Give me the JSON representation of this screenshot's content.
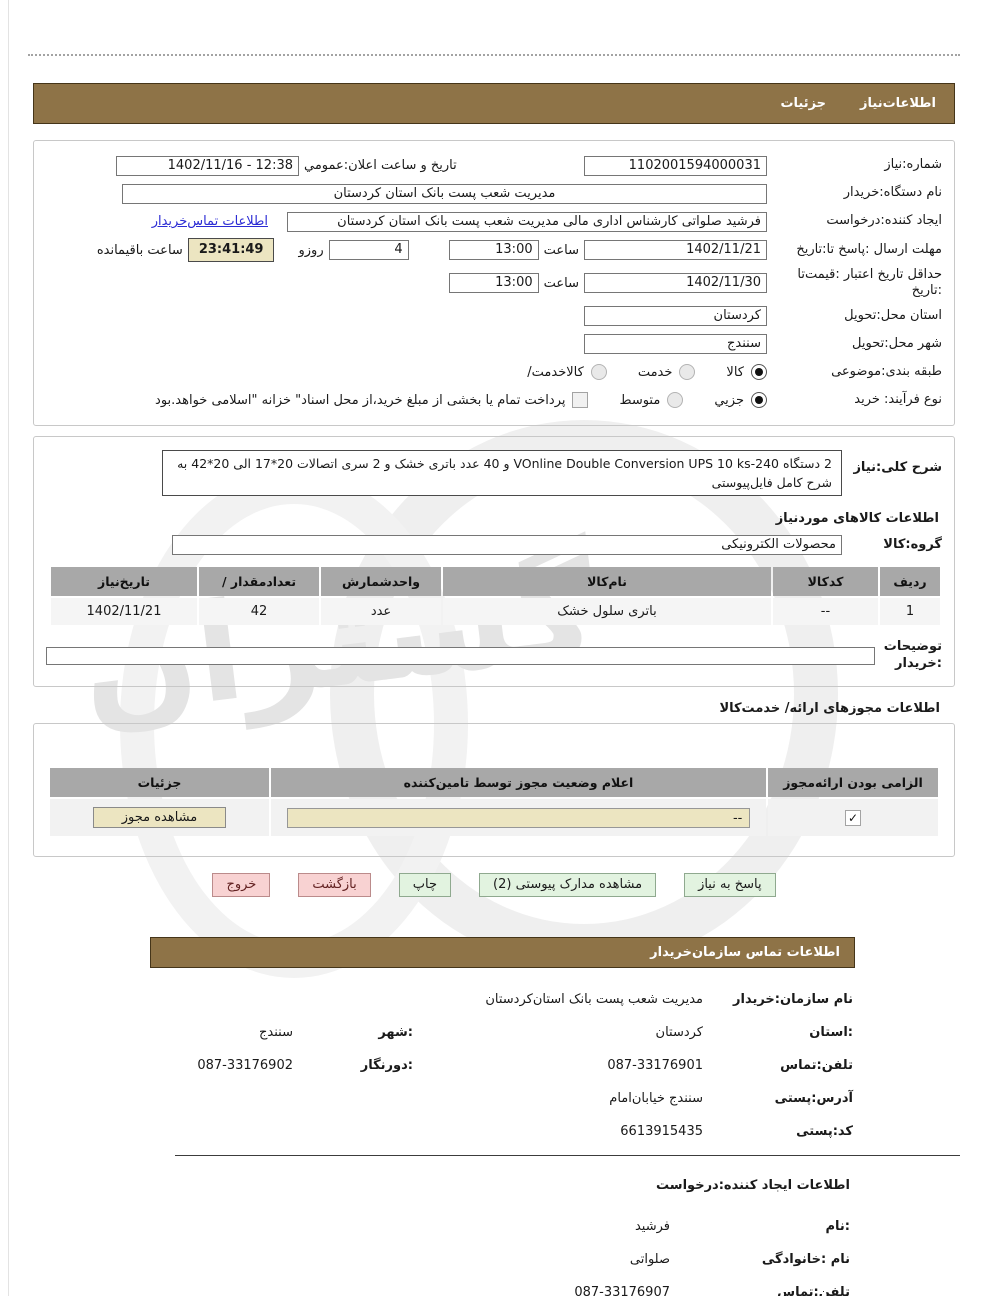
{
  "colors": {
    "header_brown": "#8e7347",
    "link_blue": "#2b2bd4",
    "button_green_bg": "#e2f3e0",
    "button_pink_bg": "#f8d2d2",
    "highlight_beige": "#ece5c1",
    "table_header_gray": "#a8a8a8"
  },
  "watermark": {
    "text": "گستران"
  },
  "tabs": {
    "need_info": "اطلاعات‌نیاز",
    "details": "جزئیات"
  },
  "need_form": {
    "need_number_label": "شماره:نیاز",
    "need_number": "1102001594000031",
    "announce_label": "تاریخ و ساعت اعلان:عمومي",
    "announce_value": "12:38 - 1402/11/16",
    "org_label": "نام دستگاه:خریدار",
    "org_value": "مدیریت شعب پست بانک استان کردستان",
    "creator_label": "ایجاد کننده:درخواست",
    "creator_value": "فرشید صلواتی کارشناس اداری مالی مدیریت شعب پست بانک استان کردستان",
    "contact_link": "اطلاعات تماس‌خریدار",
    "deadline_label": "مهلت ارسال :پاسخ تا:تاریخ",
    "deadline_date": "1402/11/21",
    "hour_label": "ساعت",
    "deadline_time": "13:00",
    "days_value": "4",
    "days_label": "روزو",
    "remaining_value": "23:41:49",
    "remaining_label": "ساعت باقیمانده",
    "validity_label": "حداقل تاریخ اعتبار :قیمت‌تا :تاریخ",
    "validity_date": "1402/11/30",
    "validity_time": "13:00",
    "province_label": "استان محل:تحویل",
    "province_value": "کردستان",
    "city_label": "شهر محل:تحویل",
    "city_value": "سنندج",
    "category_label": "طبقه بندی:موضوعی",
    "category_options": [
      {
        "label": "کالا",
        "selected": true
      },
      {
        "label": "خدمت",
        "selected": false
      },
      {
        "label": "کالاخدمت/",
        "selected": false
      }
    ],
    "process_label": "نوع فرآیند: خرید",
    "process_options": [
      {
        "label": "جزیي",
        "selected": true
      },
      {
        "label": "متوسط",
        "selected": false
      }
    ],
    "payment_checkbox_checked": false,
    "payment_checkbox_label": "پرداخت تمام یا بخشی از مبلغ خرید،از محل اسناد\" خزانه \"اسلامی خواهد.بود"
  },
  "description": {
    "label": "شرح کلی:نیاز",
    "text": "2 دستگاه   VOnline Double Conversion UPS 10 ks-240 و 40 عدد باتری خشک و 2 سری اتصالات 20*17 الی 20*42 به شرح کامل فایل‌پیوستی"
  },
  "items_section": {
    "heading": "اطلاعات کالاهای موردنیاز",
    "group_label": "گروه:کالا",
    "group_value": "محصولات الکترونیکی",
    "table": {
      "headers": [
        "ردیف",
        "کدکالا",
        "نام‌کالا",
        "واحدشمارش",
        "تعدادمقدار /",
        "تاریخ‌نیاز"
      ],
      "rows": [
        [
          "1",
          "--",
          "باتری سلول خشک",
          "عدد",
          "42",
          "1402/11/21"
        ]
      ]
    },
    "notes_label": "توضیحات :خریدار"
  },
  "permits_section": {
    "heading": "اطلاعات مجوزهای ارائه/ خدمت‌کالا",
    "table_headers": [
      "الزامی بودن ارائه‌مجوز",
      "اعلام وضعیت مجوز توسط تامین‌کننده",
      "جزئیات"
    ],
    "required_checked": true,
    "status_value": "--",
    "view_button": "مشاهده مجوز"
  },
  "actions": {
    "respond": "پاسخ به نیاز",
    "view_docs": "مشاهده مدارک پیوستی (2)",
    "print": "چاپ",
    "back": "بازگشت",
    "exit": "خروج"
  },
  "buyer_contact": {
    "header": "اطلاعات  تماس سازمان‌خریدار",
    "org_label": "نام سازمان:خریدار",
    "org_value": "مدیریت شعب پست بانک استان‌کردستان",
    "province_label": ":استان",
    "province_value": "کردستان",
    "city_label": ":شهر",
    "city_value": "سنندج",
    "phone_label": "تلفن:تماس",
    "phone_value": "087-33176901",
    "fax_label": ":دورنگار",
    "fax_value": "087-33176902",
    "address_label": "آدرس:پستی",
    "address_value": "سنندج خیابان‌امام",
    "postal_label": "کد:پستی",
    "postal_value": "6613915435"
  },
  "creator_info": {
    "heading": "اطلاعات ایجاد کننده:درخواست",
    "name_label": ":نام",
    "name_value": "فرشید",
    "family_label": "نام :خانوادگی",
    "family_value": "صلواتی",
    "phone_label": "تلفن:تماس",
    "phone_value": "087-33176907"
  },
  "icons": {
    "checkmark": "✓"
  }
}
